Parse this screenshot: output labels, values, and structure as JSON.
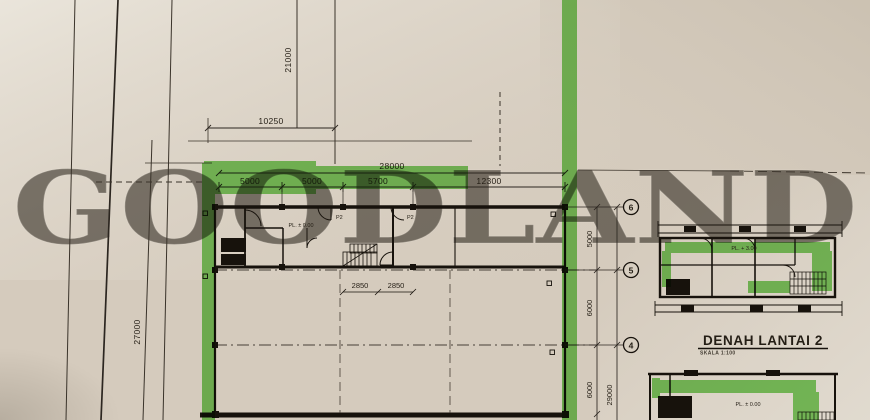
{
  "watermark": "GOODLAND",
  "colors": {
    "highlight": "#57c33e",
    "ink": "#241e15",
    "paper": "#d5cbbd"
  },
  "site_plan": {
    "dim_top_vertical": "21000",
    "dim_top_horizontal": "10250",
    "dim_left_vertical": "27000"
  },
  "main_plan": {
    "total_width_label": "28000",
    "bay_labels": [
      "5000",
      "5000",
      "5700",
      "12300"
    ],
    "stair_dim_labels": [
      "2850",
      "2850"
    ],
    "level_label": "PL. ± 0.00",
    "door_labels": [
      "P2",
      "P2"
    ],
    "grid_bubble_labels": [
      "6",
      "5",
      "4"
    ],
    "right_dim_labels": [
      "5000",
      "6000",
      "6000"
    ],
    "right_total_label": "29000"
  },
  "floor2_plan": {
    "title": "DENAH LANTAI 2",
    "scale_label": "SKALA 1:100",
    "level_label": "PL. + 3.00"
  },
  "floor1_bottom_plan": {
    "level_label": "PL. ± 0.00"
  }
}
